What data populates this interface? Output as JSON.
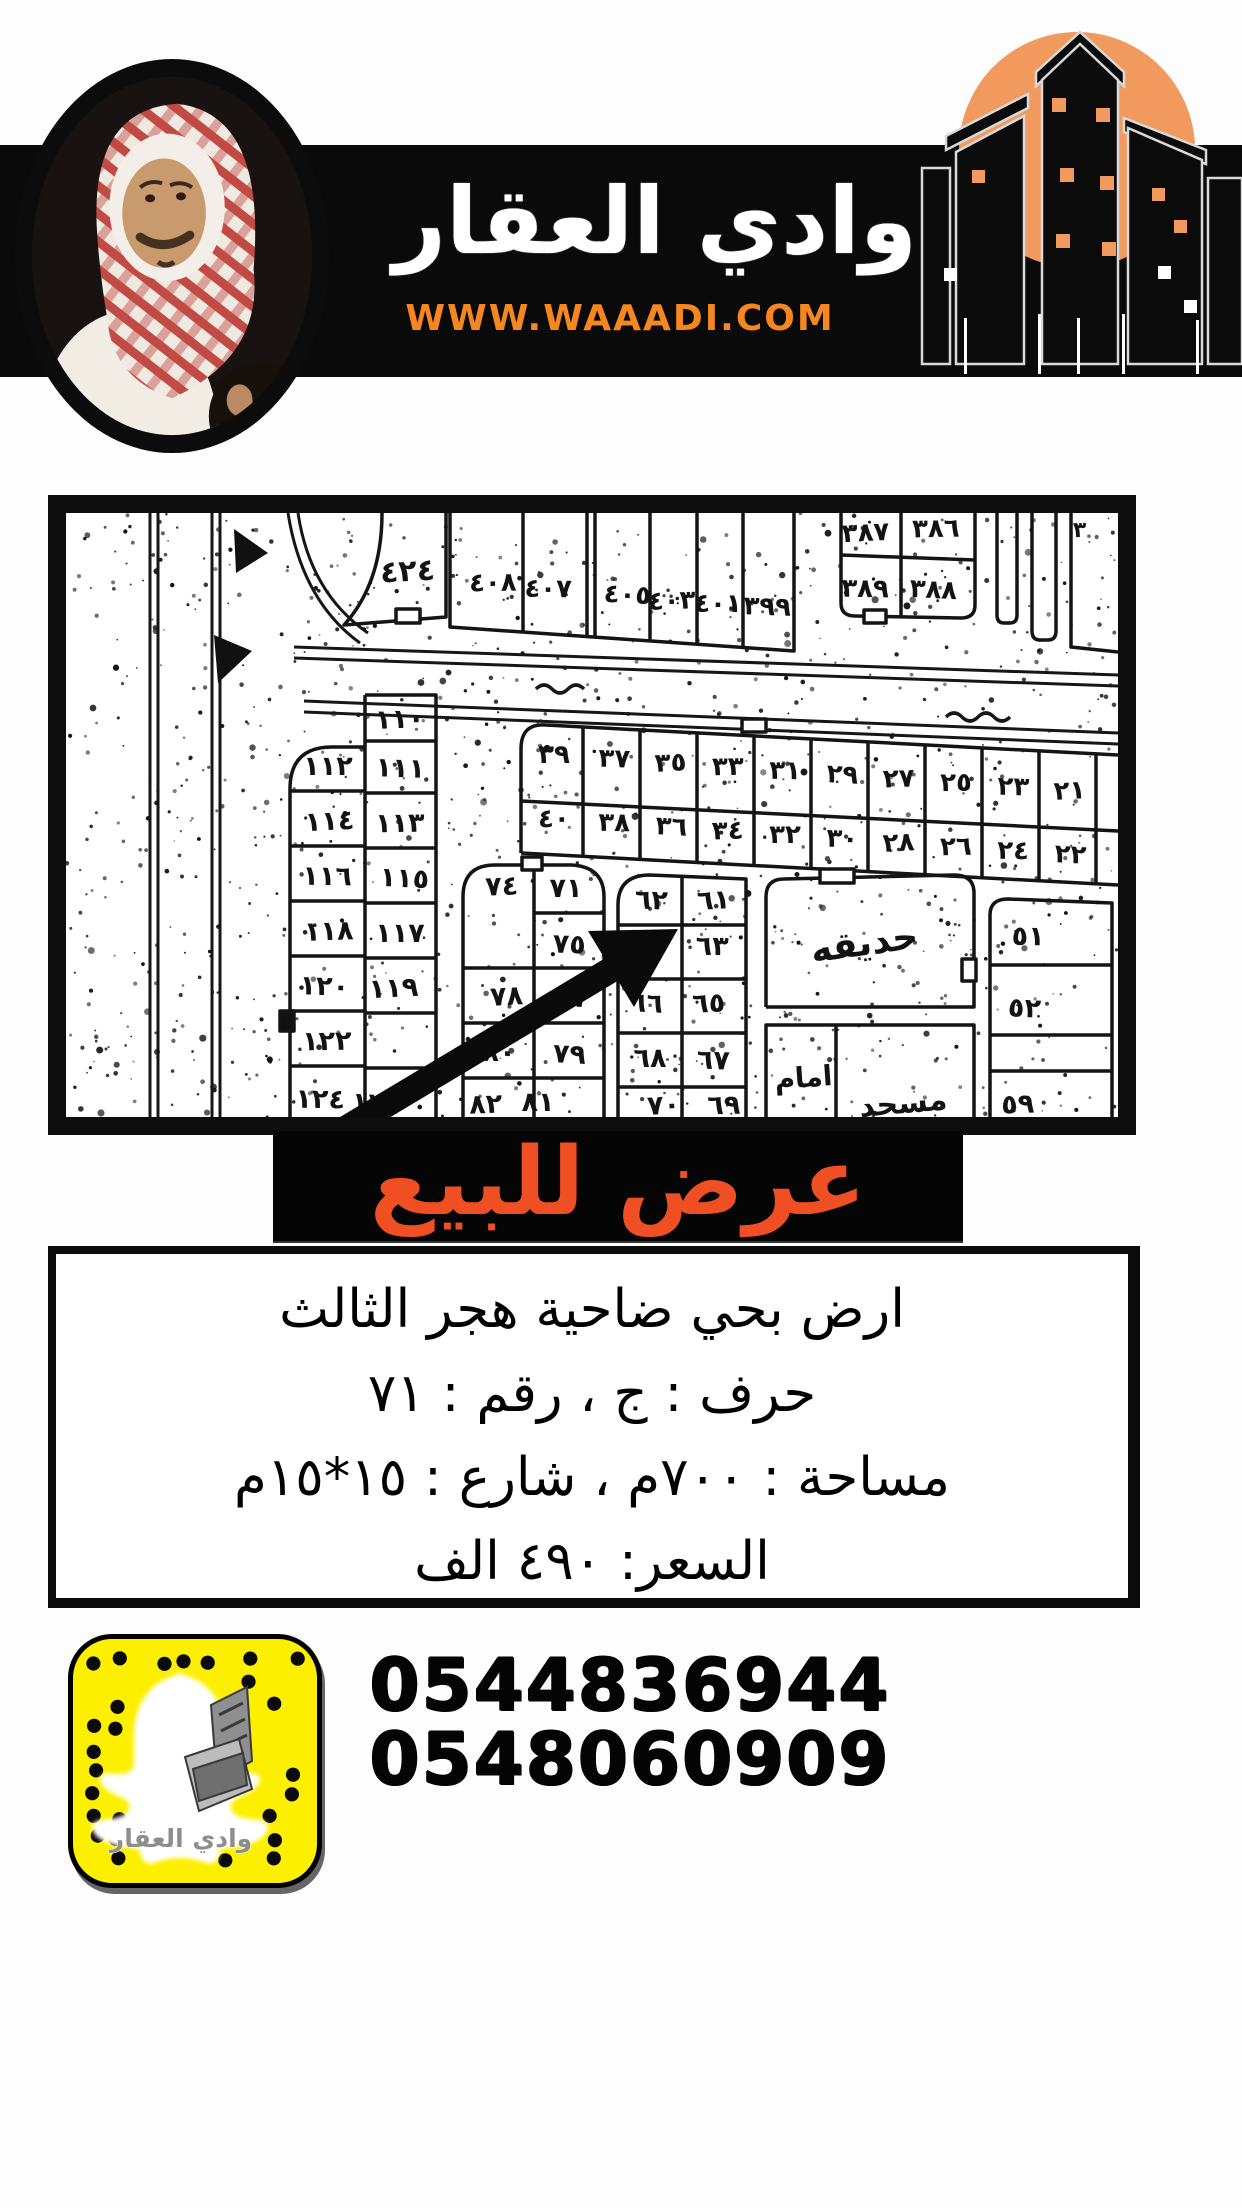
{
  "header": {
    "brand_name": "وادي العقار",
    "website": "WWW.WAAADI.COM"
  },
  "colors": {
    "accent_orange": "#f6861f",
    "banner_text_red": "#f04f24",
    "logo_circle_orange": "#f2995e",
    "snapcode_yellow": "#fdef00",
    "bar_black": "#0a0a0a"
  },
  "banner": {
    "text": "عرض للبيع"
  },
  "details": {
    "lines": [
      "ارض بحي ضاحية هجر الثالث",
      "حرف : ج ، رقم : ٧١",
      "مساحة : ٧٠٠م ، شارع : ١٥*١٥م",
      "السعر: ٤٩٠ الف"
    ]
  },
  "contact": {
    "phones": [
      "0544836944",
      "0548060909"
    ]
  },
  "snapcode": {
    "caption": "وادي العقار"
  },
  "map": {
    "arrow_target": "٧١",
    "labels": [
      {
        "t": "٤٢٤",
        "x": 342,
        "y": 68,
        "s": 30
      },
      {
        "t": "٤٠٨",
        "x": 427,
        "y": 78,
        "s": 26
      },
      {
        "t": "٤٠٧",
        "x": 482,
        "y": 84,
        "s": 26
      },
      {
        "t": "٤٠٥",
        "x": 561,
        "y": 90,
        "s": 26
      },
      {
        "t": "٤٠٣",
        "x": 606,
        "y": 96,
        "s": 26
      },
      {
        "t": "٤٠١",
        "x": 652,
        "y": 99,
        "s": 26
      },
      {
        "t": "٣٩٩",
        "x": 701,
        "y": 102,
        "s": 26
      },
      {
        "t": "٣٨٧",
        "x": 800,
        "y": 28,
        "s": 26
      },
      {
        "t": "٣٨٦",
        "x": 870,
        "y": 24,
        "s": 26
      },
      {
        "t": "٣٨٩",
        "x": 799,
        "y": 84,
        "s": 26
      },
      {
        "t": "٣٨٨",
        "x": 867,
        "y": 85,
        "s": 26
      },
      {
        "t": "٣",
        "x": 1014,
        "y": 24,
        "s": 22
      },
      {
        "t": "٣٩",
        "x": 488,
        "y": 250,
        "s": 26
      },
      {
        "t": "٣٧",
        "x": 548,
        "y": 254,
        "s": 26
      },
      {
        "t": "٣٥",
        "x": 605,
        "y": 258,
        "s": 26
      },
      {
        "t": "٣٣",
        "x": 662,
        "y": 262,
        "s": 26
      },
      {
        "t": "٣١",
        "x": 719,
        "y": 266,
        "s": 26
      },
      {
        "t": "٢٩",
        "x": 776,
        "y": 270,
        "s": 26
      },
      {
        "t": "٢٧",
        "x": 833,
        "y": 274,
        "s": 26
      },
      {
        "t": "٢٥",
        "x": 890,
        "y": 278,
        "s": 26
      },
      {
        "t": "٢٣",
        "x": 947,
        "y": 282,
        "s": 26
      },
      {
        "t": "٢١",
        "x": 1004,
        "y": 286,
        "s": 26
      },
      {
        "t": "٤٠",
        "x": 488,
        "y": 314,
        "s": 26
      },
      {
        "t": "٣٨",
        "x": 548,
        "y": 318,
        "s": 26
      },
      {
        "t": "٣٦",
        "x": 605,
        "y": 322,
        "s": 26
      },
      {
        "t": "٣٤",
        "x": 662,
        "y": 326,
        "s": 26
      },
      {
        "t": "٣٢",
        "x": 719,
        "y": 330,
        "s": 26
      },
      {
        "t": "٣٠",
        "x": 776,
        "y": 334,
        "s": 26
      },
      {
        "t": "٢٨",
        "x": 833,
        "y": 338,
        "s": 26
      },
      {
        "t": "٢٦",
        "x": 890,
        "y": 342,
        "s": 26
      },
      {
        "t": "٢٤",
        "x": 947,
        "y": 346,
        "s": 26
      },
      {
        "t": "٢٢",
        "x": 1004,
        "y": 350,
        "s": 26
      },
      {
        "t": "١١٠",
        "x": 334,
        "y": 215,
        "s": 27
      },
      {
        "t": "١١٢",
        "x": 262,
        "y": 262,
        "s": 27
      },
      {
        "t": "١١١",
        "x": 334,
        "y": 264,
        "s": 27
      },
      {
        "t": "١١٤",
        "x": 264,
        "y": 317,
        "s": 27
      },
      {
        "t": "١١٣",
        "x": 334,
        "y": 319,
        "s": 27
      },
      {
        "t": "١١٦",
        "x": 261,
        "y": 372,
        "s": 27
      },
      {
        "t": "١١٥",
        "x": 338,
        "y": 374,
        "s": 27
      },
      {
        "t": "١١٨",
        "x": 263,
        "y": 427,
        "s": 27
      },
      {
        "t": "١١٧",
        "x": 334,
        "y": 429,
        "s": 27
      },
      {
        "t": "١٢٠",
        "x": 258,
        "y": 482,
        "s": 27
      },
      {
        "t": "١١٩",
        "x": 328,
        "y": 484,
        "s": 27
      },
      {
        "t": "١٢٢",
        "x": 261,
        "y": 537,
        "s": 27
      },
      {
        "t": "١٢٤",
        "x": 254,
        "y": 595,
        "s": 27
      },
      {
        "t": "١٢٣",
        "x": 310,
        "y": 599,
        "s": 27
      },
      {
        "t": "٧٤",
        "x": 436,
        "y": 382,
        "s": 27
      },
      {
        "t": "٧١",
        "x": 500,
        "y": 384,
        "s": 27
      },
      {
        "t": "٧٥",
        "x": 503,
        "y": 440,
        "s": 27
      },
      {
        "t": "٧٨",
        "x": 441,
        "y": 492,
        "s": 27
      },
      {
        "t": "٧٧",
        "x": 505,
        "y": 494,
        "s": 27
      },
      {
        "t": "٨٠",
        "x": 433,
        "y": 548,
        "s": 27
      },
      {
        "t": "٧٩",
        "x": 503,
        "y": 550,
        "s": 27
      },
      {
        "t": "٨٢",
        "x": 420,
        "y": 600,
        "s": 27
      },
      {
        "t": "٨١",
        "x": 472,
        "y": 598,
        "s": 27
      },
      {
        "t": "٦٢",
        "x": 585,
        "y": 396,
        "s": 27
      },
      {
        "t": "٦١",
        "x": 648,
        "y": 396,
        "s": 27
      },
      {
        "t": "٦٤",
        "x": 583,
        "y": 442,
        "s": 27
      },
      {
        "t": "٦٣",
        "x": 646,
        "y": 442,
        "s": 27
      },
      {
        "t": "٦٦",
        "x": 580,
        "y": 499,
        "s": 27
      },
      {
        "t": "٦٥",
        "x": 643,
        "y": 499,
        "s": 27
      },
      {
        "t": "٦٨",
        "x": 584,
        "y": 554,
        "s": 27
      },
      {
        "t": "٦٧",
        "x": 647,
        "y": 556,
        "s": 27
      },
      {
        "t": "٧٠",
        "x": 598,
        "y": 601,
        "s": 27
      },
      {
        "t": "٦٩",
        "x": 658,
        "y": 601,
        "s": 27
      },
      {
        "t": "٥١",
        "x": 962,
        "y": 432,
        "s": 27
      },
      {
        "t": "٥٢",
        "x": 958,
        "y": 504,
        "s": 27
      },
      {
        "t": "٥٩",
        "x": 952,
        "y": 600,
        "s": 27
      },
      {
        "t": "حديقه",
        "x": 800,
        "y": 442,
        "s": 36,
        "r": -8
      },
      {
        "t": "امام",
        "x": 738,
        "y": 574,
        "s": 28,
        "r": -4
      },
      {
        "t": "مسجد",
        "x": 838,
        "y": 600,
        "s": 30,
        "r": -5
      }
    ]
  }
}
